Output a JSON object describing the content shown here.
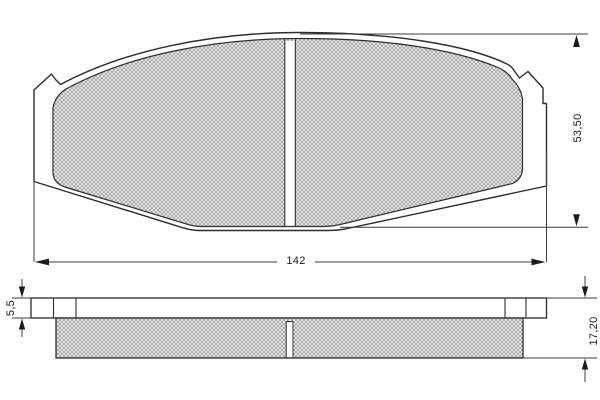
{
  "drawing": {
    "title": "brake-pad-technical-drawing",
    "views": {
      "top_view": "pad face view",
      "side_view": "pad profile view"
    },
    "dimensions": {
      "pad_width": {
        "label": "142",
        "orientation": "horizontal"
      },
      "pad_height": {
        "label": "53,50",
        "orientation": "vertical"
      },
      "backplate_thickness": {
        "label": "5,5",
        "orientation": "vertical"
      },
      "total_thickness": {
        "label": "17,20",
        "orientation": "vertical"
      }
    },
    "colors": {
      "background": "#ffffff",
      "outline": "#2d2d2d",
      "dimension_line": "#3c3c3c",
      "hatch_line": "#9b9b9b",
      "hatch_background": "#f6f6f6",
      "text": "#1b1b1b"
    }
  }
}
